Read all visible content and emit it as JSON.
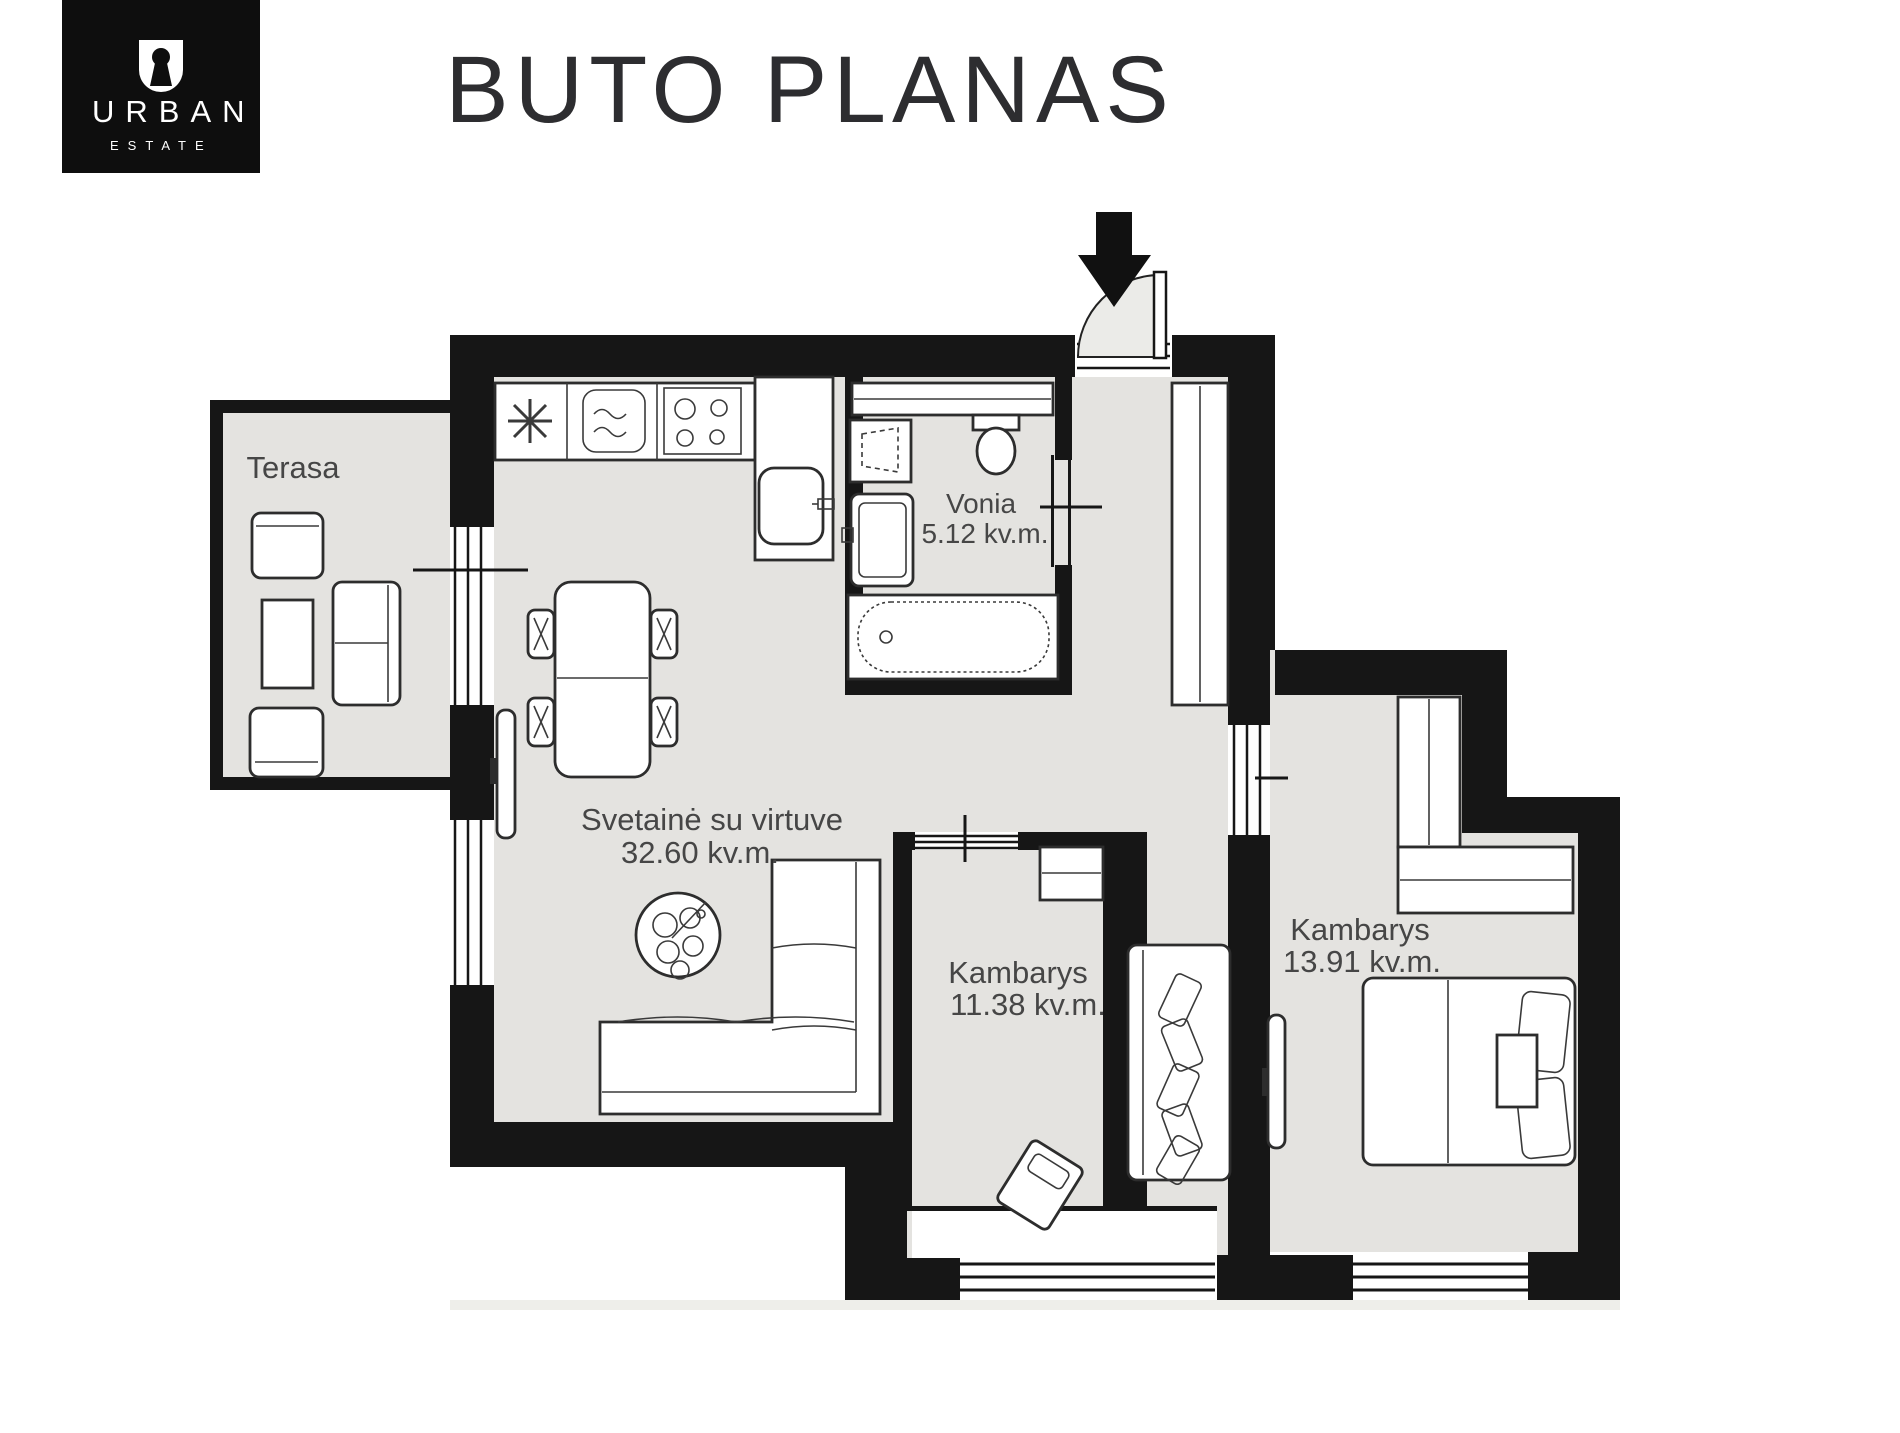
{
  "logo": {
    "brand": "URBAN",
    "sub": "ESTATE"
  },
  "title": "BUTO PLANAS",
  "rooms": {
    "terrace": {
      "name": "Terasa"
    },
    "living": {
      "name": "Svetainė su virtuve",
      "area": "32.60 kv.m."
    },
    "bathroom": {
      "name": "Vonia",
      "area": "5.12 kv.m."
    },
    "bedroom1": {
      "name": "Kambarys",
      "area": "11.38 kv.m."
    },
    "bedroom2": {
      "name": "Kambarys",
      "area": "13.91 kv.m."
    }
  },
  "colors": {
    "wall": "#161616",
    "floor": "#e4e3e0",
    "door_swing": "#ebebe8",
    "title_text": "#2d2d30",
    "label_text": "#464646",
    "logo_bg": "#0e0e0e",
    "logo_text": "#ffffff"
  },
  "icons": {
    "logo_mark": "keyhole-in-U",
    "entrance": "down-arrow"
  }
}
